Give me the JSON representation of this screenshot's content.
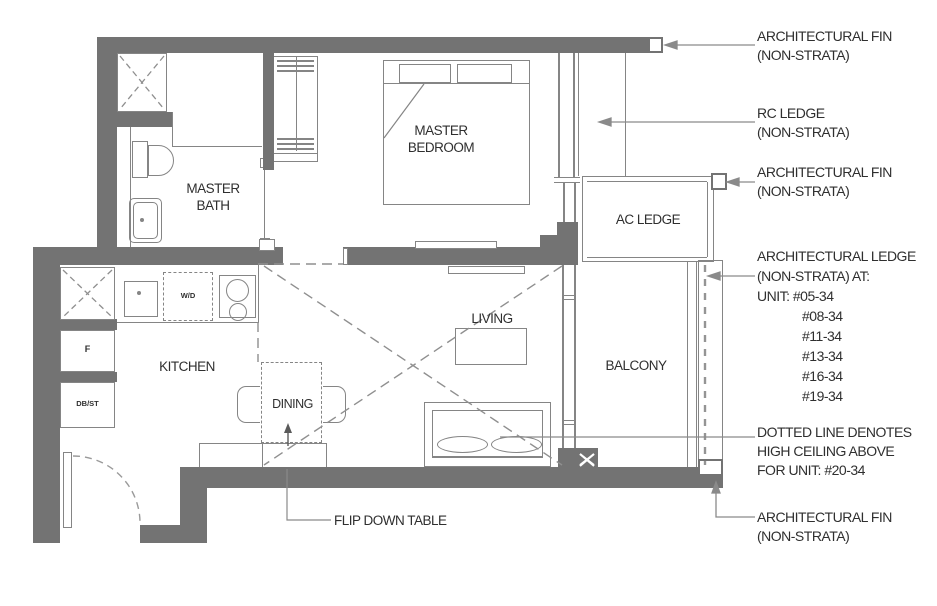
{
  "rooms": {
    "master_bedroom": {
      "line1": "MASTER",
      "line2": "BEDROOM"
    },
    "master_bath": {
      "line1": "MASTER",
      "line2": "BATH"
    },
    "kitchen": "KITCHEN",
    "dining": "DINING",
    "living": "LIVING",
    "balcony": "BALCONY",
    "ac_ledge": "AC LEDGE"
  },
  "fixtures": {
    "washer_dryer": "W/D",
    "fridge": "F",
    "db_st": "DB/ST"
  },
  "callouts": {
    "fin_top": {
      "line1": "ARCHITECTURAL FIN",
      "line2": "(NON-STRATA)"
    },
    "rc_ledge": {
      "line1": "RC LEDGE",
      "line2": "(NON-STRATA)"
    },
    "fin_mid": {
      "line1": "ARCHITECTURAL FIN",
      "line2": "(NON-STRATA)"
    },
    "arch_ledge": {
      "line1": "ARCHITECTURAL LEDGE",
      "line2": "(NON-STRATA) AT:",
      "line3": "UNIT: #05-34",
      "units": [
        "#08-34",
        "#11-34",
        "#13-34",
        "#16-34",
        "#19-34"
      ]
    },
    "high_ceiling": {
      "line1": "DOTTED LINE DENOTES",
      "line2": "HIGH CEILING ABOVE",
      "line3": "FOR UNIT: #20-34"
    },
    "fin_bottom": {
      "line1": "ARCHITECTURAL FIN",
      "line2": "(NON-STRATA)"
    },
    "flip_table": "FLIP DOWN TABLE"
  },
  "colors": {
    "wall": "#737373",
    "line": "#858585",
    "text": "#2f2f2f",
    "background": "#ffffff"
  }
}
